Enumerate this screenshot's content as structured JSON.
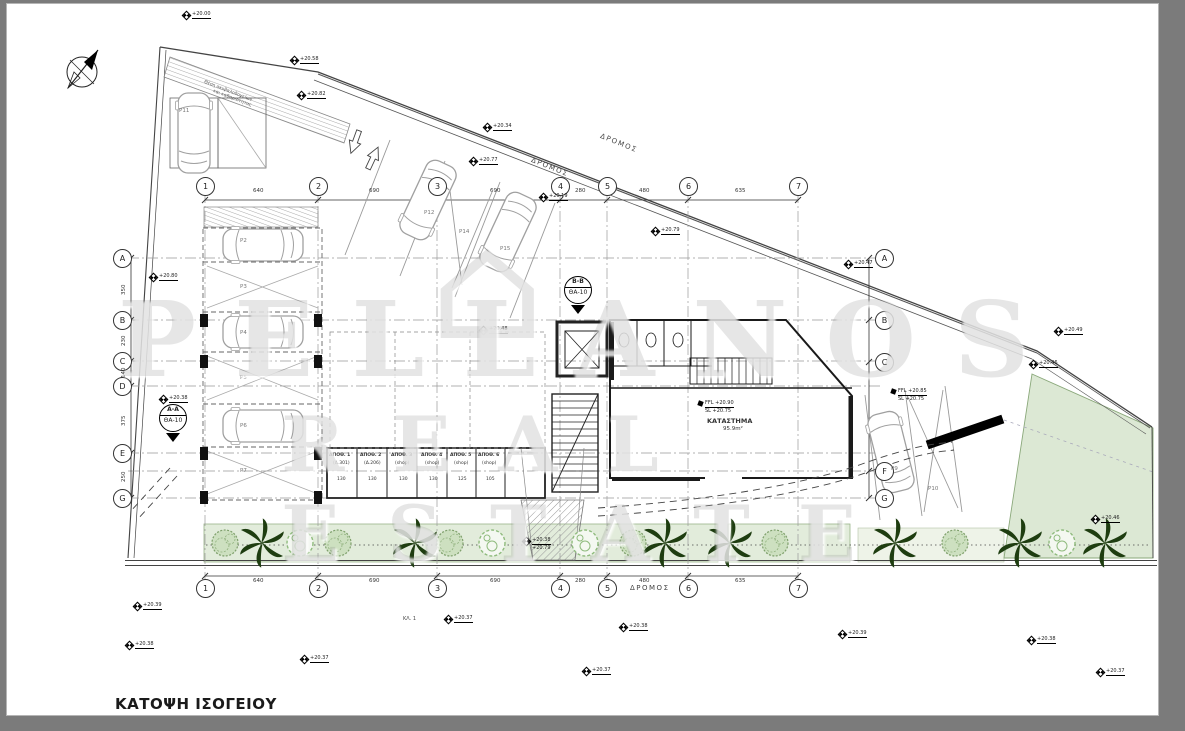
{
  "window": {
    "background": "#7b7b7b",
    "canvas_color": "#ffffff"
  },
  "title": "ΚΑΤΟΨΗ ΙΣΟΓΕΙΟΥ",
  "watermark": {
    "line1": "PELLANOS",
    "line2": "REAL ESTATE",
    "house_glyph": "⌂"
  },
  "colors": {
    "planting_green": "#e2ecdb",
    "garden_green": "#dce8d4",
    "tree_dark": "#1e3d10",
    "tree_light": "#8fbb7d",
    "line": "#333333"
  },
  "grid": {
    "columns": [
      {
        "label": "1",
        "x": 205
      },
      {
        "label": "2",
        "x": 318
      },
      {
        "label": "3",
        "x": 437
      },
      {
        "label": "4",
        "x": 560
      },
      {
        "label": "5",
        "x": 607
      },
      {
        "label": "6",
        "x": 688
      },
      {
        "label": "7",
        "x": 798
      }
    ],
    "rows_left": [
      {
        "label": "A",
        "y": 258
      },
      {
        "label": "B",
        "y": 320
      },
      {
        "label": "C",
        "y": 361
      },
      {
        "label": "D",
        "y": 386
      },
      {
        "label": "E",
        "y": 453
      },
      {
        "label": "G",
        "y": 498
      }
    ],
    "rows_right": [
      {
        "label": "A",
        "y": 258
      },
      {
        "label": "B",
        "y": 320
      },
      {
        "label": "C",
        "y": 362
      },
      {
        "label": "F",
        "y": 471
      },
      {
        "label": "G",
        "y": 498
      }
    ]
  },
  "dimensions": {
    "top": [
      {
        "label": "640",
        "x": 261
      },
      {
        "label": "690",
        "x": 377
      },
      {
        "label": "690",
        "x": 498
      },
      {
        "label": "280",
        "x": 583
      },
      {
        "label": "480",
        "x": 647
      },
      {
        "label": "635",
        "x": 743
      }
    ],
    "bottom": [
      {
        "label": "640",
        "x": 261
      },
      {
        "label": "690",
        "x": 377
      },
      {
        "label": "690",
        "x": 498
      },
      {
        "label": "280",
        "x": 583
      },
      {
        "label": "480",
        "x": 647
      },
      {
        "label": "635",
        "x": 743
      }
    ],
    "left": [
      {
        "label": "350",
        "y": 295
      },
      {
        "label": "230",
        "y": 346
      },
      {
        "label": "140",
        "y": 378
      },
      {
        "label": "375",
        "y": 426
      },
      {
        "label": "250",
        "y": 482
      }
    ]
  },
  "road_labels": [
    {
      "text": "ΔΡΟΜΟΣ",
      "x": 533,
      "y": 156,
      "rot": 22
    },
    {
      "text": "ΔΡΟΜΟΣ",
      "x": 602,
      "y": 132,
      "rot": 22
    },
    {
      "text": "ΔΡΟΜΟΣ",
      "x": 630,
      "y": 584,
      "rot": 0
    }
  ],
  "section_markers": [
    {
      "top": "A-A",
      "bottom": "ΘΑ-10",
      "x": 159,
      "y": 404
    },
    {
      "top": "B-B",
      "bottom": "ΘΑ-10",
      "x": 564,
      "y": 276
    }
  ],
  "shop": {
    "label": "ΚΑΤΑΣΤΗΜΑ",
    "area": "95.9m²",
    "x": 737,
    "y": 417
  },
  "storage_rooms": [
    {
      "label": "ΑΠΟΘ. 1",
      "sub": "(Δ.301)",
      "dim": "130",
      "x": 342
    },
    {
      "label": "ΑΠΟΘ. 2",
      "sub": "(Δ.206)",
      "dim": "130",
      "x": 373
    },
    {
      "label": "ΑΠΟΘ. 3",
      "sub": "(shop)",
      "dim": "130",
      "x": 404
    },
    {
      "label": "ΑΠΟΘ. 4",
      "sub": "(shop)",
      "dim": "130",
      "x": 434
    },
    {
      "label": "ΑΠΟΘ. 5",
      "sub": "(shop)",
      "dim": "125",
      "x": 463
    },
    {
      "label": "ΑΠΟΘ. 6",
      "sub": "(shop)",
      "dim": "105",
      "x": 491
    }
  ],
  "parking_labels": [
    {
      "label": "P11",
      "x": 179,
      "y": 108
    },
    {
      "label": "P12",
      "x": 424,
      "y": 210
    },
    {
      "label": "P14",
      "x": 459,
      "y": 229
    },
    {
      "label": "P15",
      "x": 500,
      "y": 246
    },
    {
      "label": "P2",
      "x": 240,
      "y": 238
    },
    {
      "label": "P3",
      "x": 240,
      "y": 284
    },
    {
      "label": "P4",
      "x": 240,
      "y": 330
    },
    {
      "label": "P5",
      "x": 240,
      "y": 375
    },
    {
      "label": "P6",
      "x": 240,
      "y": 423
    },
    {
      "label": "P7",
      "x": 240,
      "y": 468
    },
    {
      "label": "P9",
      "x": 891,
      "y": 466
    },
    {
      "label": "P10",
      "x": 928,
      "y": 486
    }
  ],
  "spot_elevations": [
    {
      "x": 183,
      "y": 14,
      "label": "+20.00"
    },
    {
      "x": 291,
      "y": 59,
      "label": "+20.58"
    },
    {
      "x": 298,
      "y": 94,
      "label": "+20.82"
    },
    {
      "x": 484,
      "y": 126,
      "label": "+20.34"
    },
    {
      "x": 470,
      "y": 160,
      "label": "+20.77"
    },
    {
      "x": 540,
      "y": 196,
      "label": "+20.19"
    },
    {
      "x": 652,
      "y": 230,
      "label": "+20.79"
    },
    {
      "x": 845,
      "y": 263,
      "label": "+20.47"
    },
    {
      "x": 1055,
      "y": 330,
      "label": "+20.49"
    },
    {
      "x": 1030,
      "y": 363,
      "label": "+20.46"
    },
    {
      "x": 1092,
      "y": 518,
      "label": "+20.46"
    },
    {
      "x": 480,
      "y": 329,
      "label": "+20.48"
    },
    {
      "x": 150,
      "y": 276,
      "label": "+20.80"
    },
    {
      "x": 160,
      "y": 398,
      "label": "+20.38"
    },
    {
      "x": 134,
      "y": 605,
      "label": "+20.39"
    },
    {
      "x": 126,
      "y": 644,
      "label": "+20.38"
    },
    {
      "x": 301,
      "y": 658,
      "label": "+20.37"
    },
    {
      "x": 445,
      "y": 618,
      "label": "+20.37"
    },
    {
      "x": 583,
      "y": 670,
      "label": "+20.37"
    },
    {
      "x": 620,
      "y": 626,
      "label": "+20.38"
    },
    {
      "x": 839,
      "y": 633,
      "label": "+20.39"
    },
    {
      "x": 1028,
      "y": 639,
      "label": "+20.38"
    },
    {
      "x": 1097,
      "y": 671,
      "label": "+20.37"
    },
    {
      "x": 523,
      "y": 540,
      "label": "+20.38",
      "sub": "+20.79"
    }
  ],
  "ffl_markers": [
    {
      "label": "FFL +20.90",
      "sub": "SL +20.75",
      "x": 698,
      "y": 403
    },
    {
      "label": "FFL +20.85",
      "sub": "SL +20.75",
      "x": 891,
      "y": 391
    }
  ],
  "notes": [
    {
      "text": "Θέση σκυβαλοδοχείων",
      "x": 205,
      "y": 80,
      "rot": 21
    },
    {
      "text": "και καθαριότητας",
      "x": 214,
      "y": 89,
      "rot": 21
    }
  ],
  "misc_labels": [
    {
      "text": "ΚΛ. 1",
      "x": 403,
      "y": 616,
      "rot": 0
    }
  ]
}
